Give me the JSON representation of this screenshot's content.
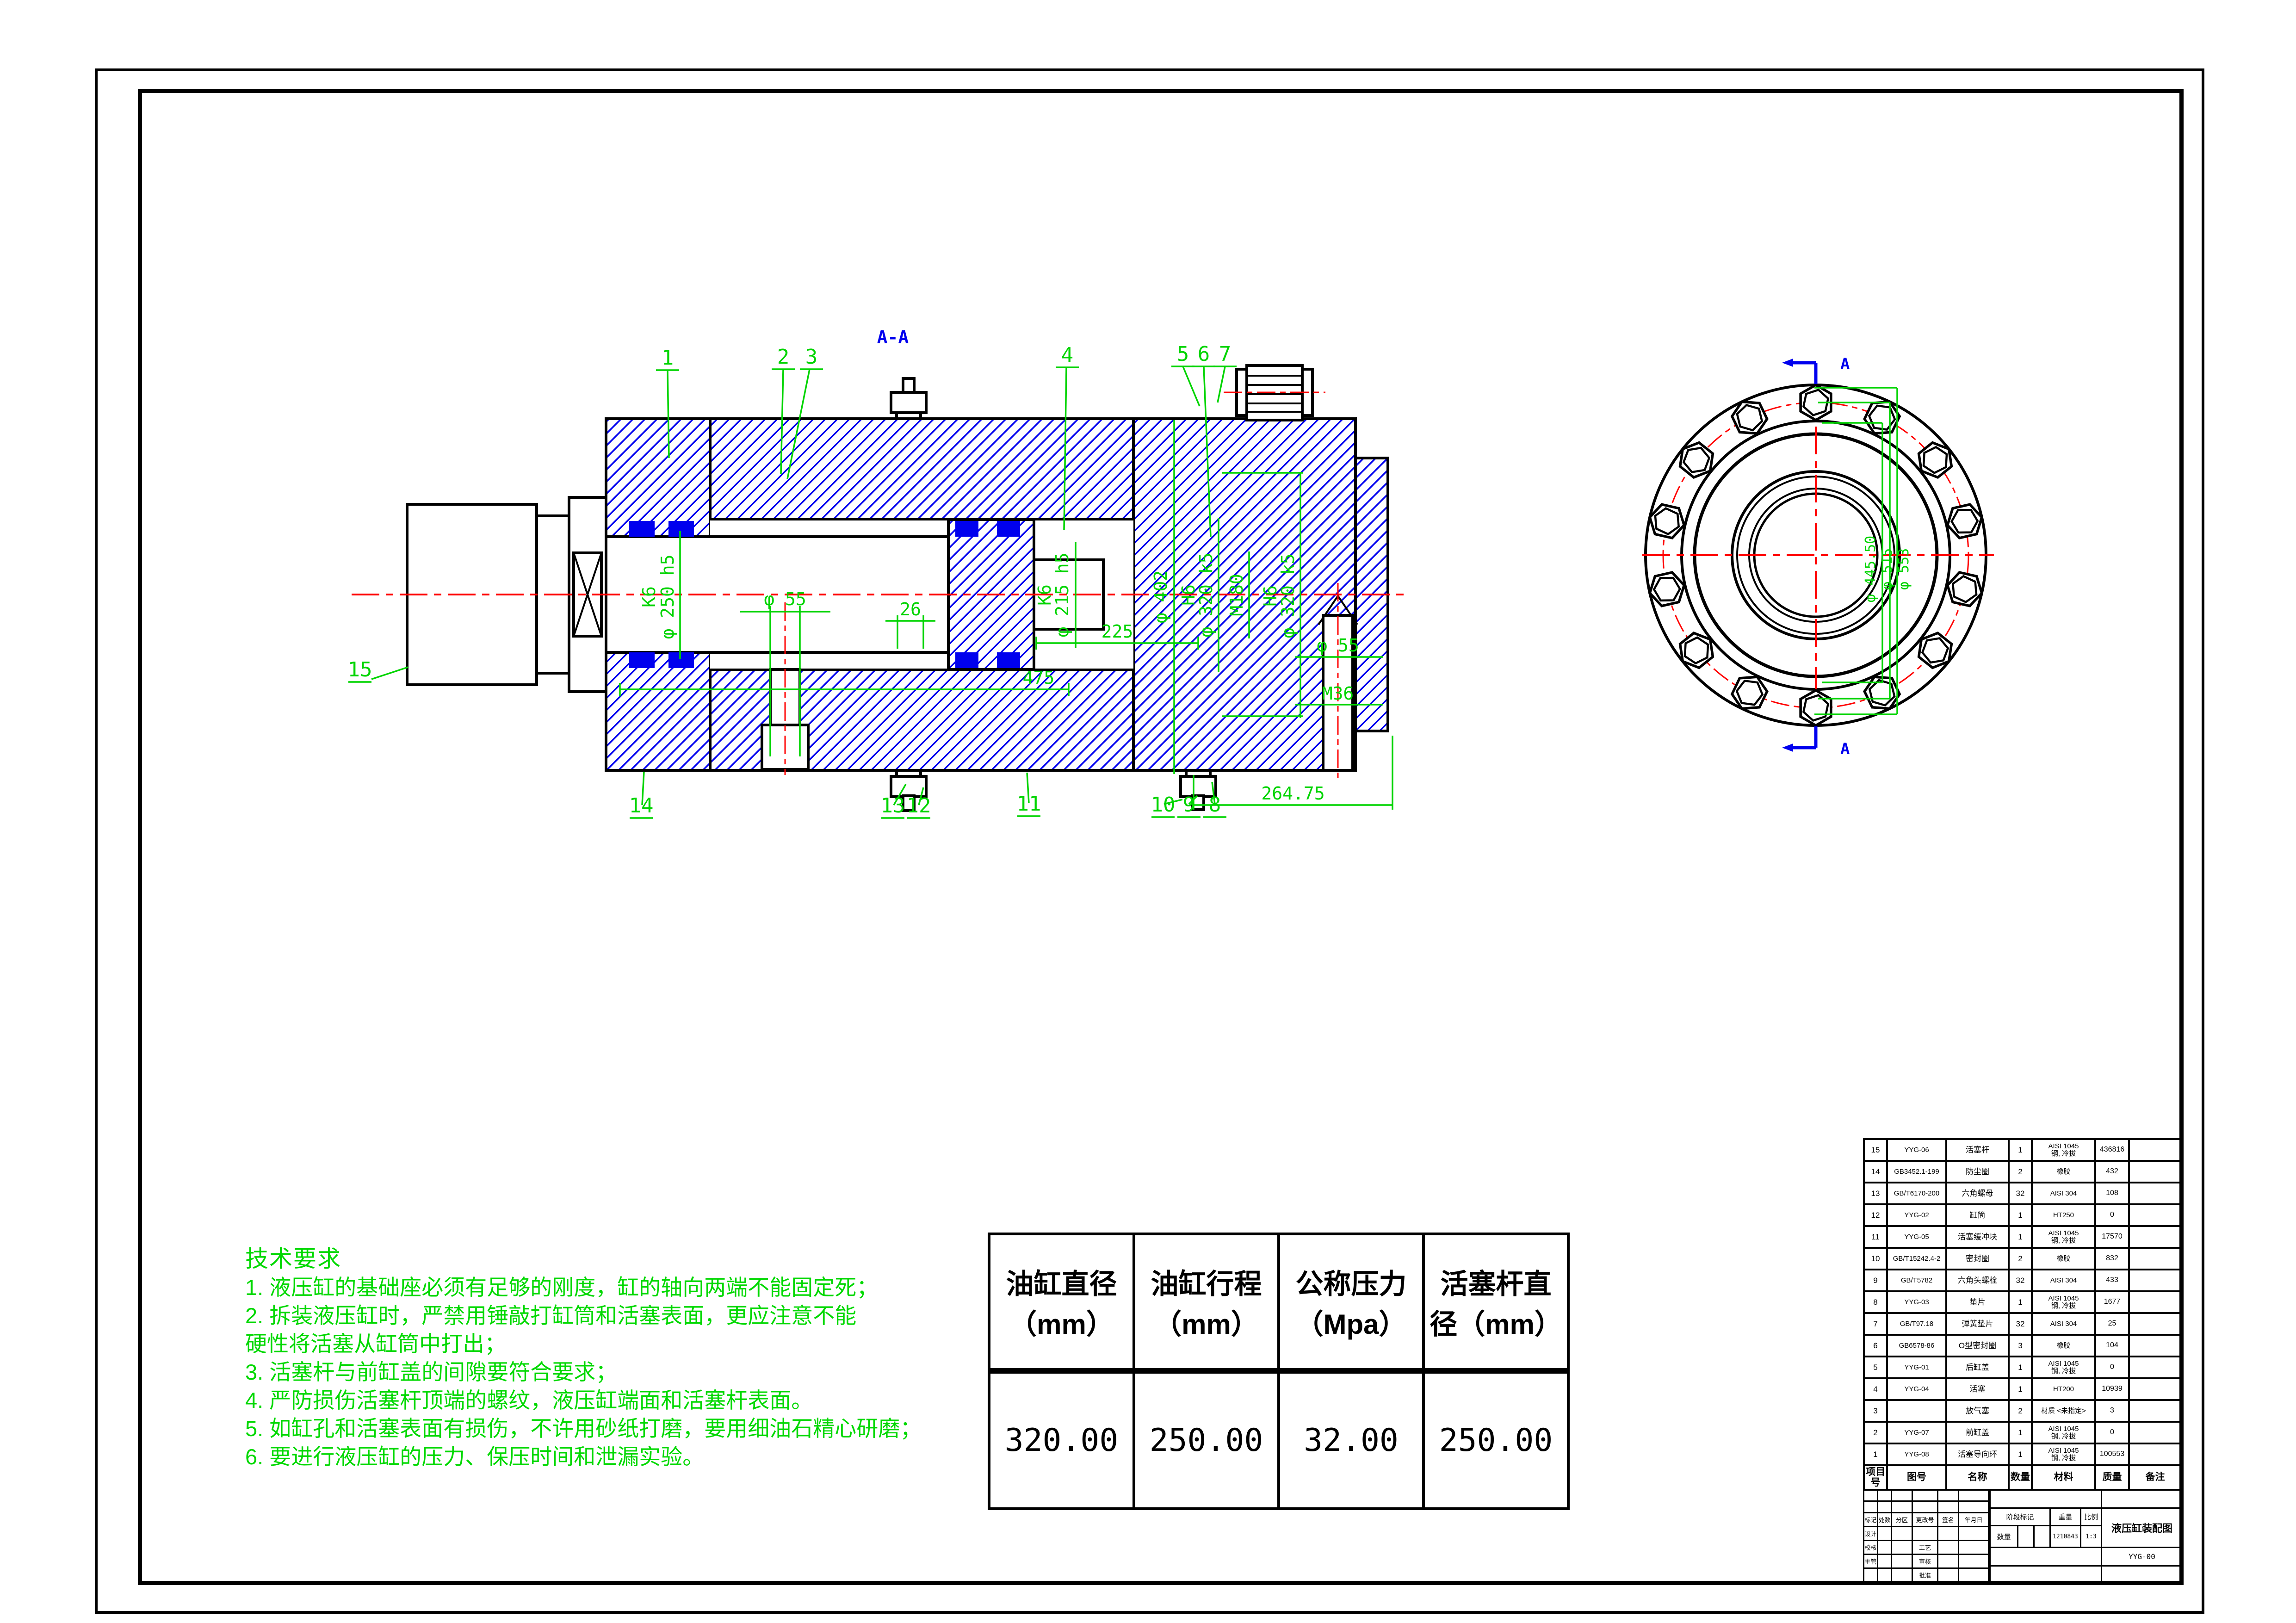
{
  "colors": {
    "dimension_green": "#00d400",
    "notes_green": "#00d800",
    "hatch_blue": "#0000ee",
    "centerline_red": "#ff0000"
  },
  "tech": {
    "title": "技术要求",
    "lines": [
      "1. 液压缸的基础座必须有足够的刚度，缸的轴向两端不能固定死；",
      "2. 拆装液压缸时，严禁用锤敲打缸筒和活塞表面，更应注意不能",
      "硬性将活塞从缸筒中打出；",
      "3. 活塞杆与前缸盖的间隙要符合要求；",
      "4. 严防损伤活塞杆顶端的螺纹，液压缸端面和活塞杆表面。",
      "5. 如缸孔和活塞表面有损伤，不许用砂纸打磨，要用细油石精心研磨；",
      "6. 要进行液压缸的压力、保压时间和泄漏实验。"
    ]
  },
  "param_table": {
    "headers": [
      [
        "油缸直径",
        "（mm）"
      ],
      [
        "油缸行程",
        "（mm）"
      ],
      [
        "公称压力",
        "（Mpa）"
      ],
      [
        "活塞杆直",
        "径（mm）"
      ]
    ],
    "values": [
      "320.00",
      "250.00",
      "32.00",
      "250.00"
    ]
  },
  "bom": {
    "columns": [
      {
        "key": "no",
        "label": "项目号"
      },
      {
        "key": "code",
        "label": "图号"
      },
      {
        "key": "name",
        "label": "名称"
      },
      {
        "key": "qty",
        "label": "数量"
      },
      {
        "key": "material",
        "label": "材料"
      },
      {
        "key": "mass",
        "label": "质量"
      },
      {
        "key": "note",
        "label": "备注"
      }
    ],
    "rows": [
      {
        "no": "15",
        "code": "YYG-06",
        "name": "活塞杆",
        "qty": "1",
        "material": "AISI 1045\n钢, 冷拔",
        "mass": "436816",
        "note": ""
      },
      {
        "no": "14",
        "code": "GB3452.1-199",
        "name": "防尘圈",
        "qty": "2",
        "material": "橡胶",
        "mass": "432",
        "note": ""
      },
      {
        "no": "13",
        "code": "GB/T6170-200",
        "name": "六角螺母",
        "qty": "32",
        "material": "AISI 304",
        "mass": "108",
        "note": ""
      },
      {
        "no": "12",
        "code": "YYG-02",
        "name": "缸筒",
        "qty": "1",
        "material": "HT250",
        "mass": "0",
        "note": ""
      },
      {
        "no": "11",
        "code": "YYG-05",
        "name": "活塞缓冲块",
        "qty": "1",
        "material": "AISI 1045\n钢, 冷拔",
        "mass": "17570",
        "note": ""
      },
      {
        "no": "10",
        "code": "GB/T15242.4-2",
        "name": "密封圈",
        "qty": "2",
        "material": "橡胶",
        "mass": "832",
        "note": ""
      },
      {
        "no": "9",
        "code": "GB/T5782",
        "name": "六角头螺栓",
        "qty": "32",
        "material": "AISI 304",
        "mass": "433",
        "note": ""
      },
      {
        "no": "8",
        "code": "YYG-03",
        "name": "垫片",
        "qty": "1",
        "material": "AISI 1045\n钢, 冷拔",
        "mass": "1677",
        "note": ""
      },
      {
        "no": "7",
        "code": "GB/T97.18",
        "name": "弹簧垫片",
        "qty": "32",
        "material": "AISI 304",
        "mass": "25",
        "note": ""
      },
      {
        "no": "6",
        "code": "GB6578-86",
        "name": "O型密封圈",
        "qty": "3",
        "material": "橡胶",
        "mass": "104",
        "note": ""
      },
      {
        "no": "5",
        "code": "YYG-01",
        "name": "后缸盖",
        "qty": "1",
        "material": "AISI 1045\n钢, 冷拔",
        "mass": "0",
        "note": ""
      },
      {
        "no": "4",
        "code": "YYG-04",
        "name": "活塞",
        "qty": "1",
        "material": "HT200",
        "mass": "10939",
        "note": ""
      },
      {
        "no": "3",
        "code": "",
        "name": "放气塞",
        "qty": "2",
        "material": "材质 <未指定>",
        "mass": "3",
        "note": ""
      },
      {
        "no": "2",
        "code": "YYG-07",
        "name": "前缸盖",
        "qty": "1",
        "material": "AISI 1045\n钢, 冷拔",
        "mass": "0",
        "note": ""
      },
      {
        "no": "1",
        "code": "YYG-08",
        "name": "活塞导向环",
        "qty": "1",
        "material": "AISI 1045\n钢, 冷拔",
        "mass": "100553",
        "note": ""
      }
    ]
  },
  "title_block": {
    "revision_headers": [
      "标记",
      "处数",
      "分区",
      "更改号",
      "签名",
      "年月日"
    ],
    "row_labels_left": [
      "设计",
      "校核",
      "主管"
    ],
    "row_labels_mid": [
      "工艺",
      "审核",
      "批准"
    ],
    "stage_label": "阶段标记",
    "weight_label": "重量",
    "scale_label": "比例",
    "qty_label": "数量",
    "weight_value": "1210843",
    "scale_value": "1:3",
    "title": "液压缸装配图",
    "drawing_no": "YYG-00"
  },
  "drawing": {
    "section_view": {
      "label": "A-A",
      "callouts": {
        "top_left": [
          "1",
          "2",
          "3"
        ],
        "top_right": [
          "4",
          "5",
          "6",
          "7"
        ],
        "left": "15",
        "bottom": [
          "14",
          "13",
          "12",
          "11",
          "10",
          "9",
          "8"
        ]
      },
      "dims": {
        "rod_fit": "K6",
        "rod_dia": "φ 250 h5",
        "spigot_fit": "K6",
        "spigot_dia": "φ 215 h5",
        "outer_dia": "φ 402",
        "bore_fit": "H6",
        "bore_dia": "φ 320 k5",
        "thread": "M180",
        "bore2_fit": "H6",
        "bore2_dia": "φ 320 k5",
        "len_225": "225",
        "len_475": "475",
        "port_dia": "φ 55",
        "groove": "26",
        "drain_dia": "φ 55",
        "drain_thread": "M36",
        "len_264": "264.75"
      }
    },
    "end_view": {
      "marker": "A",
      "bolt_count": 14,
      "dims": [
        "φ 445.50",
        "φ 515",
        "φ 553"
      ]
    }
  }
}
